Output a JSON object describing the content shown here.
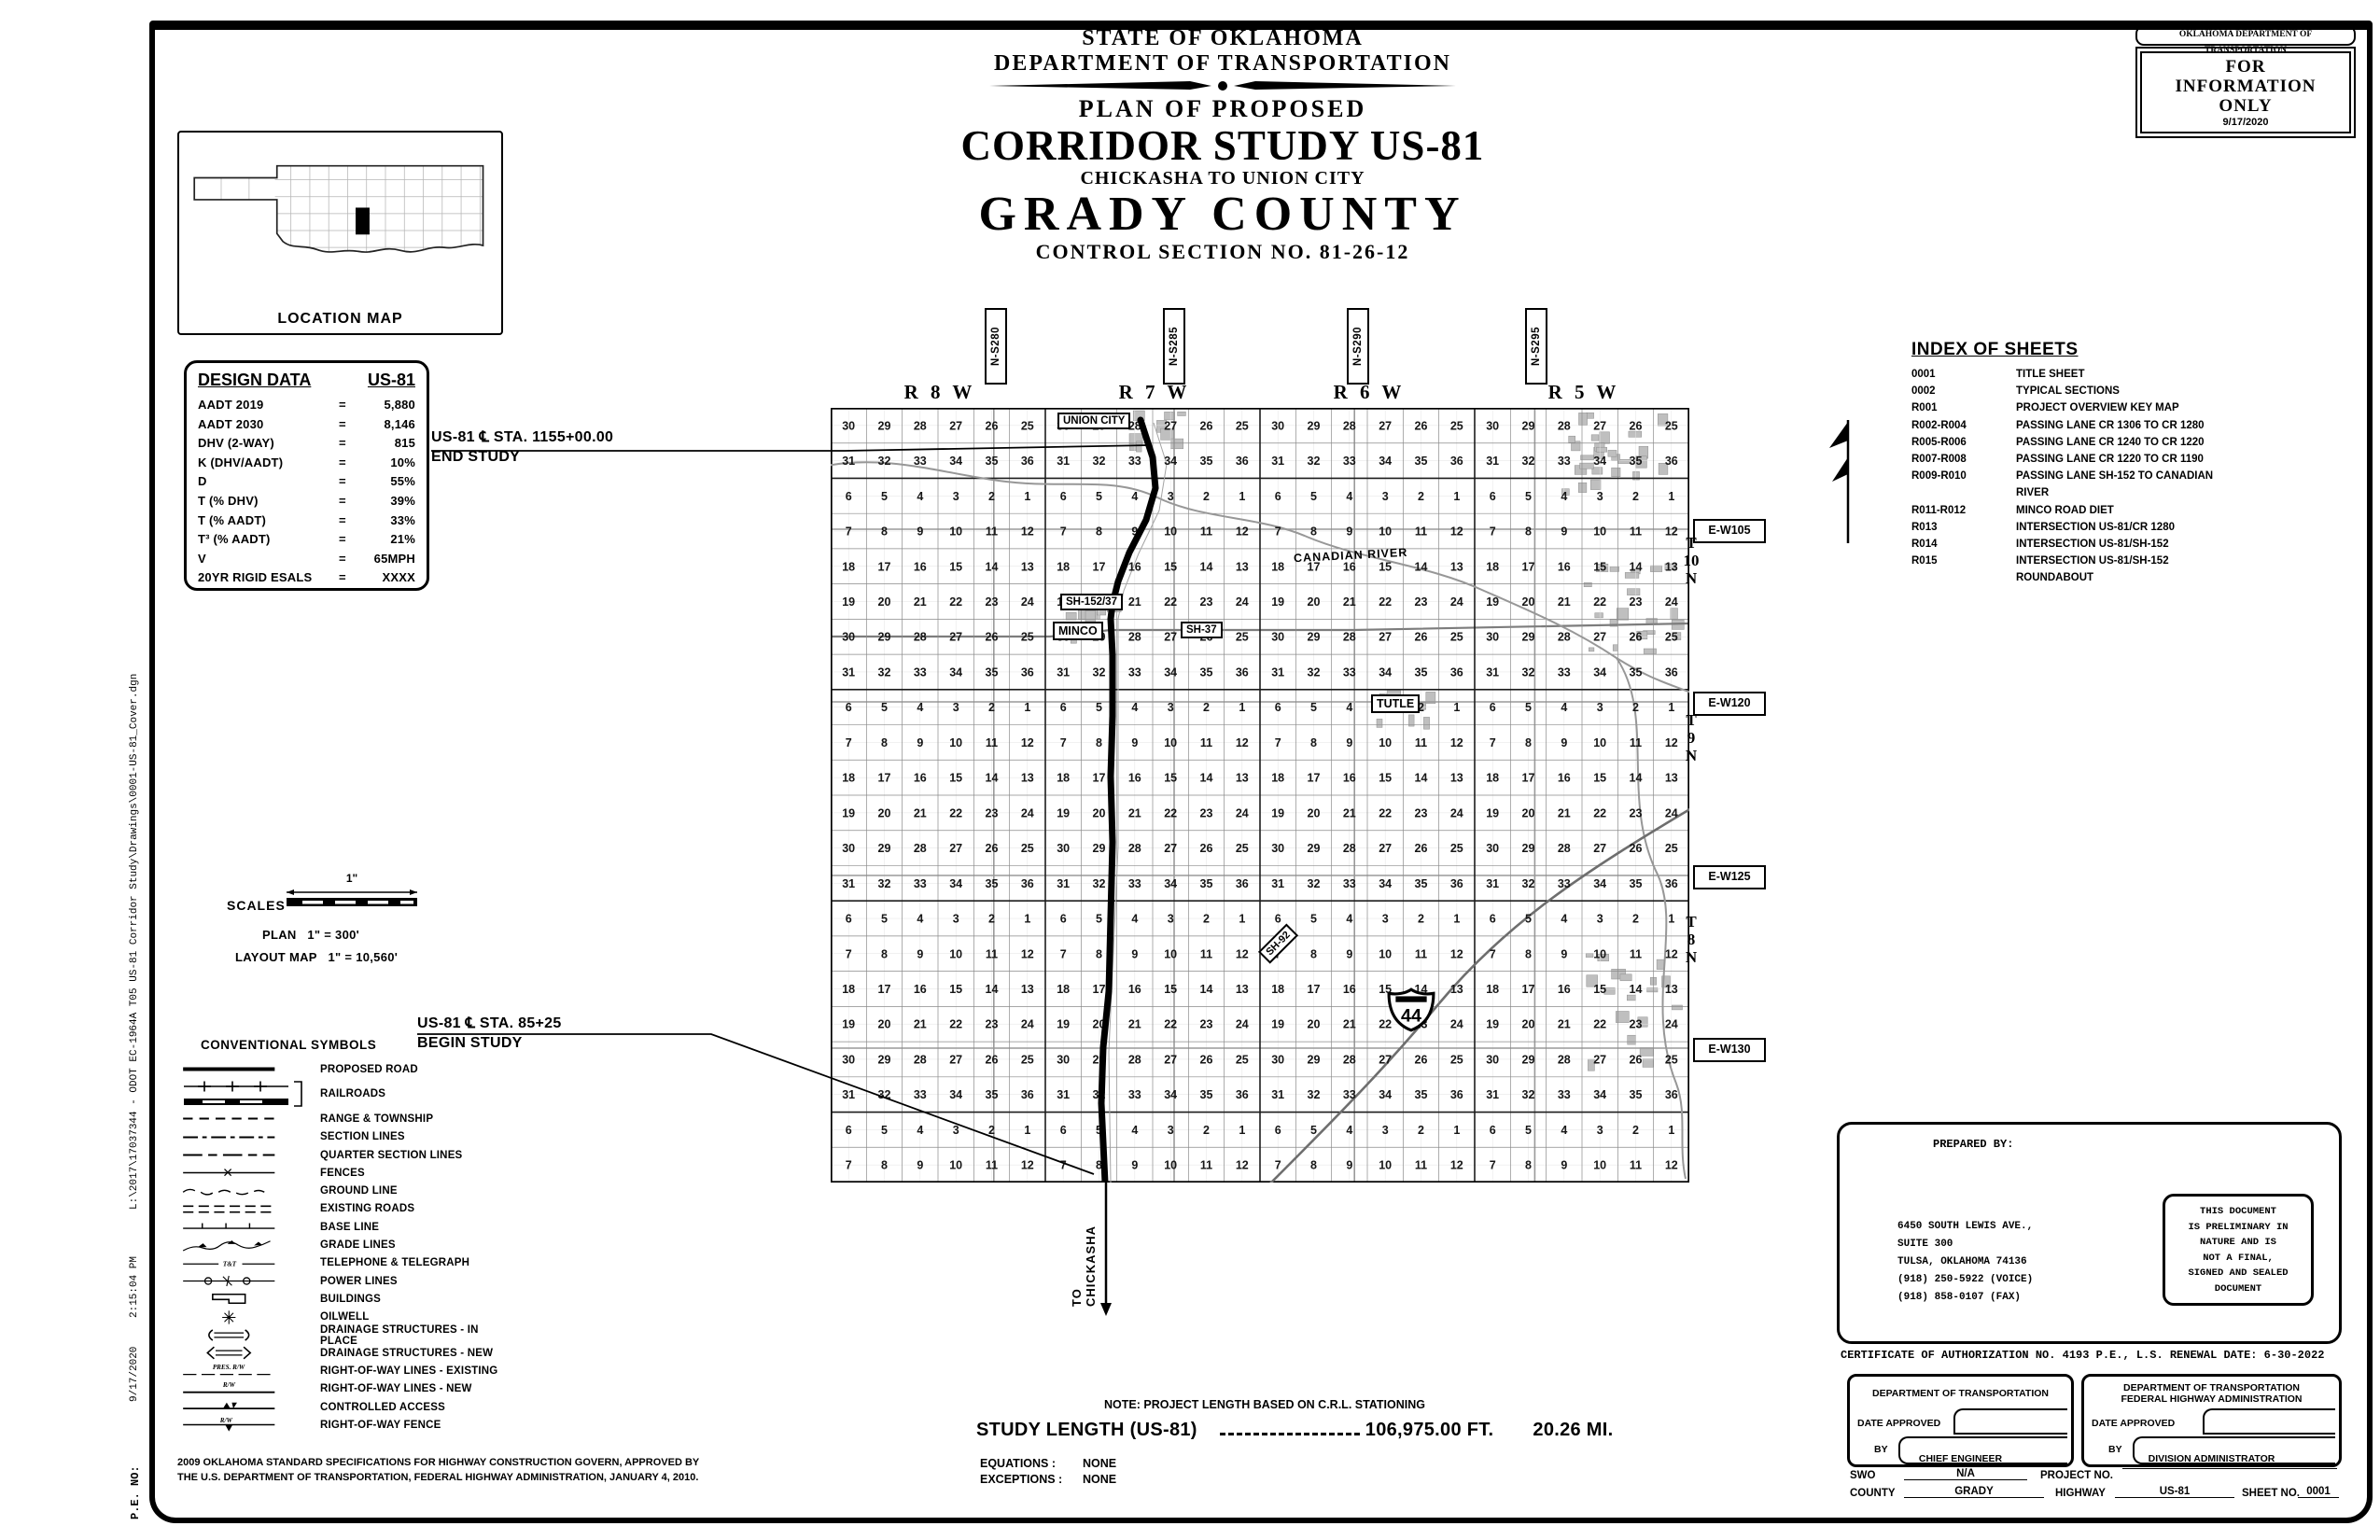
{
  "colors": {
    "paper": "#ffffff",
    "ink": "#000000",
    "map_grid": "#8a8a8a"
  },
  "stamp": {
    "agency": "OKLAHOMA DEPARTMENT OF TRANSPORTATION",
    "lines": [
      "FOR",
      "INFORMATION",
      "ONLY"
    ],
    "date": "9/17/2020"
  },
  "title": {
    "state": "STATE OF OKLAHOMA",
    "dept": "DEPARTMENT OF TRANSPORTATION",
    "plan_of": "PLAN OF PROPOSED",
    "main": "CORRIDOR STUDY US-81",
    "sub": "CHICKASHA TO UNION CITY",
    "county": "GRADY COUNTY",
    "control": "CONTROL SECTION NO. 81-26-12"
  },
  "location_map": {
    "label": "LOCATION MAP"
  },
  "design_data": {
    "title": "DESIGN DATA",
    "highway": "US-81",
    "eq": "=",
    "rows": [
      {
        "label": "AADT  2019",
        "value": "5,880"
      },
      {
        "label": "AADT  2030",
        "value": "8,146"
      },
      {
        "label": "DHV (2-WAY)",
        "value": "815"
      },
      {
        "label": "K (DHV/AADT)",
        "value": "10%"
      },
      {
        "label": "D",
        "value": "55%"
      },
      {
        "label": "T (% DHV)",
        "value": "39%"
      },
      {
        "label": "T (% AADT)",
        "value": "33%"
      },
      {
        "label": "T³ (% AADT)",
        "value": "21%"
      },
      {
        "label": "V",
        "value": "65MPH"
      },
      {
        "label": "20YR RIGID ESALS",
        "value": "XXXX"
      }
    ]
  },
  "index_of_sheets": {
    "title": "INDEX OF SHEETS",
    "rows": [
      {
        "sheet": "0001",
        "desc": "TITLE SHEET"
      },
      {
        "sheet": "0002",
        "desc": "TYPICAL SECTIONS"
      },
      {
        "sheet": "R001",
        "desc": "PROJECT OVERVIEW KEY MAP"
      },
      {
        "sheet": "R002-R004",
        "desc": "PASSING LANE CR 1306 TO CR 1280"
      },
      {
        "sheet": "R005-R006",
        "desc": "PASSING LANE CR 1240 TO CR 1220"
      },
      {
        "sheet": "R007-R008",
        "desc": "PASSING LANE CR 1220 TO CR 1190"
      },
      {
        "sheet": "R009-R010",
        "desc": "PASSING LANE SH-152 TO CANADIAN RIVER"
      },
      {
        "sheet": "R011-R012",
        "desc": "MINCO ROAD DIET"
      },
      {
        "sheet": "R013",
        "desc": "INTERSECTION US-81/CR 1280"
      },
      {
        "sheet": "R014",
        "desc": "INTERSECTION US-81/SH-152"
      },
      {
        "sheet": "R015",
        "desc": "INTERSECTION US-81/SH-152 ROUNDABOUT"
      }
    ]
  },
  "map": {
    "ranges": [
      "R 8 W",
      "R 7 W",
      "R 6 W",
      "R 5 W"
    ],
    "ns_roads": [
      "N-S280",
      "N-S285",
      "N-S290",
      "N-S295"
    ],
    "ew_roads": [
      "E-W105",
      "E-W120",
      "E-W125",
      "E-W130"
    ],
    "townships": [
      "T 10 N",
      "T 9 N",
      "T 8 N"
    ],
    "union_city": "UNION CITY",
    "minco": "MINCO",
    "tutle": "TUTLE",
    "sh152": "SH-152/37",
    "sh37": "SH-37",
    "sh92": "SH-92",
    "i44": "44",
    "river": "CANADIAN RIVER",
    "to_chickasha": [
      "TO",
      "CHICKASHA"
    ],
    "end_study": [
      "US-81 ℄ STA. 1155+00.00",
      "END STUDY"
    ],
    "begin_study": [
      "US-81 ℄ STA. 85+25",
      "BEGIN STUDY"
    ],
    "section_rows": [
      [
        30,
        29,
        28,
        27,
        26,
        25
      ],
      [
        31,
        32,
        33,
        34,
        35,
        36
      ],
      [
        6,
        5,
        4,
        3,
        2,
        1
      ],
      [
        7,
        8,
        9,
        10,
        11,
        12
      ],
      [
        18,
        17,
        16,
        15,
        14,
        13
      ],
      [
        19,
        20,
        21,
        22,
        23,
        24
      ],
      [
        30,
        29,
        28,
        27,
        26,
        25
      ],
      [
        31,
        32,
        33,
        34,
        35,
        36
      ],
      [
        6,
        5,
        4,
        3,
        2,
        1
      ],
      [
        7,
        8,
        9,
        10,
        11,
        12
      ],
      [
        18,
        17,
        16,
        15,
        14,
        13
      ],
      [
        19,
        20,
        21,
        22,
        23,
        24
      ],
      [
        30,
        29,
        28,
        27,
        26,
        25
      ],
      [
        31,
        32,
        33,
        34,
        35,
        36
      ],
      [
        6,
        5,
        4,
        3,
        2,
        1
      ],
      [
        7,
        8,
        9,
        10,
        11,
        12
      ],
      [
        18,
        17,
        16,
        15,
        14,
        13
      ],
      [
        19,
        20,
        21,
        22,
        23,
        24
      ],
      [
        30,
        29,
        28,
        27,
        26,
        25
      ],
      [
        31,
        32,
        33,
        34,
        35,
        36
      ],
      [
        6,
        5,
        4,
        3,
        2,
        1
      ],
      [
        7,
        8,
        9,
        10,
        11,
        12
      ]
    ]
  },
  "scales": {
    "title": "SCALES",
    "bar_label": "1\"",
    "plan_label": "PLAN",
    "plan_value": "1\" = 300'",
    "layout_label": "LAYOUT MAP",
    "layout_value": "1\" = 10,560'"
  },
  "symbols": {
    "title": "CONVENTIONAL SYMBOLS",
    "items": [
      {
        "icon": "proposed-road",
        "label": "PROPOSED ROAD"
      },
      {
        "icon": "railroads",
        "label": "RAILROADS"
      },
      {
        "icon": "range-township",
        "label": "RANGE & TOWNSHIP"
      },
      {
        "icon": "section-lines",
        "label": "SECTION LINES"
      },
      {
        "icon": "quarter-section-lines",
        "label": "QUARTER SECTION LINES"
      },
      {
        "icon": "fences",
        "label": "FENCES"
      },
      {
        "icon": "ground-line",
        "label": "GROUND LINE"
      },
      {
        "icon": "existing-roads",
        "label": "EXISTING ROADS"
      },
      {
        "icon": "base-line",
        "label": "BASE LINE"
      },
      {
        "icon": "grade-lines",
        "label": "GRADE LINES"
      },
      {
        "icon": "telephone-telegraph",
        "label": "TELEPHONE & TELEGRAPH",
        "icon_text": "T&T"
      },
      {
        "icon": "power-lines",
        "label": "POWER LINES"
      },
      {
        "icon": "buildings",
        "label": "BUILDINGS"
      },
      {
        "icon": "oilwell",
        "label": "OILWELL"
      },
      {
        "icon": "drainage-in-place",
        "label": "DRAINAGE STRUCTURES - IN PLACE"
      },
      {
        "icon": "drainage-new",
        "label": "DRAINAGE STRUCTURES - NEW"
      },
      {
        "icon": "row-existing",
        "label": "RIGHT-OF-WAY LINES - EXISTING",
        "icon_text": "PRES. R/W"
      },
      {
        "icon": "row-new",
        "label": "RIGHT-OF-WAY LINES - NEW",
        "icon_text": "R/W"
      },
      {
        "icon": "controlled-access",
        "label": "CONTROLLED ACCESS"
      },
      {
        "icon": "row-fence",
        "label": "RIGHT-OF-WAY FENCE",
        "icon_text": "R/W"
      }
    ]
  },
  "spec_note": {
    "lines": [
      "2009 OKLAHOMA STANDARD SPECIFICATIONS FOR HIGHWAY CONSTRUCTION GOVERN, APPROVED BY",
      "THE U.S. DEPARTMENT OF TRANSPORTATION, FEDERAL HIGHWAY ADMINISTRATION, JANUARY 4, 2010."
    ]
  },
  "study": {
    "note": "NOTE: PROJECT LENGTH BASED ON C.R.L. STATIONING",
    "length_label": "STUDY LENGTH (US-81)",
    "length_ft": "106,975.00  FT.",
    "length_mi": "20.26 MI.",
    "equations_label": "EQUATIONS :",
    "equations": "NONE",
    "exceptions_label": "EXCEPTIONS :",
    "exceptions": "NONE"
  },
  "title_block": {
    "prepared_by": "PREPARED BY:",
    "address": [
      "6450 SOUTH LEWIS AVE.,",
      "SUITE 300",
      "TULSA, OKLAHOMA 74136",
      "(918) 250-5922 (VOICE)",
      "(918) 858-0107 (FAX)"
    ],
    "disclaimer": [
      "THIS DOCUMENT",
      "IS PRELIMINARY IN",
      "NATURE AND IS",
      "NOT A FINAL,",
      "SIGNED AND SEALED",
      "DOCUMENT"
    ],
    "certificate": "CERTIFICATE OF AUTHORIZATION NO. 4193 P.E., L.S. RENEWAL DATE: 6-30-2022",
    "odot_box": {
      "title": "DEPARTMENT OF TRANSPORTATION",
      "date_label": "DATE APPROVED",
      "by_label": "BY",
      "role": "CHIEF ENGINEER"
    },
    "fhwa_box": {
      "title1": "DEPARTMENT OF TRANSPORTATION",
      "title2": "FEDERAL HIGHWAY ADMINISTRATION",
      "date_label": "DATE APPROVED",
      "by_label": "BY",
      "role": "DIVISION ADMINISTRATOR"
    },
    "footer": {
      "swo_label": "SWO",
      "swo": "N/A",
      "project_label": "PROJECT NO.",
      "project": "",
      "county_label": "COUNTY",
      "county": "GRADY",
      "highway_label": "HIGHWAY",
      "highway": "US-81",
      "sheet_label": "SHEET NO.",
      "sheet": "0001"
    }
  },
  "margin": {
    "pe": "P.E. NO:",
    "date": "9/17/2020",
    "time": "2:15:04 PM",
    "path": "L:\\2017\\17037344 - ODOT EC-1964A T05 US-81 Corridor Study\\Drawings\\0001-US-81_Cover.dgn"
  }
}
